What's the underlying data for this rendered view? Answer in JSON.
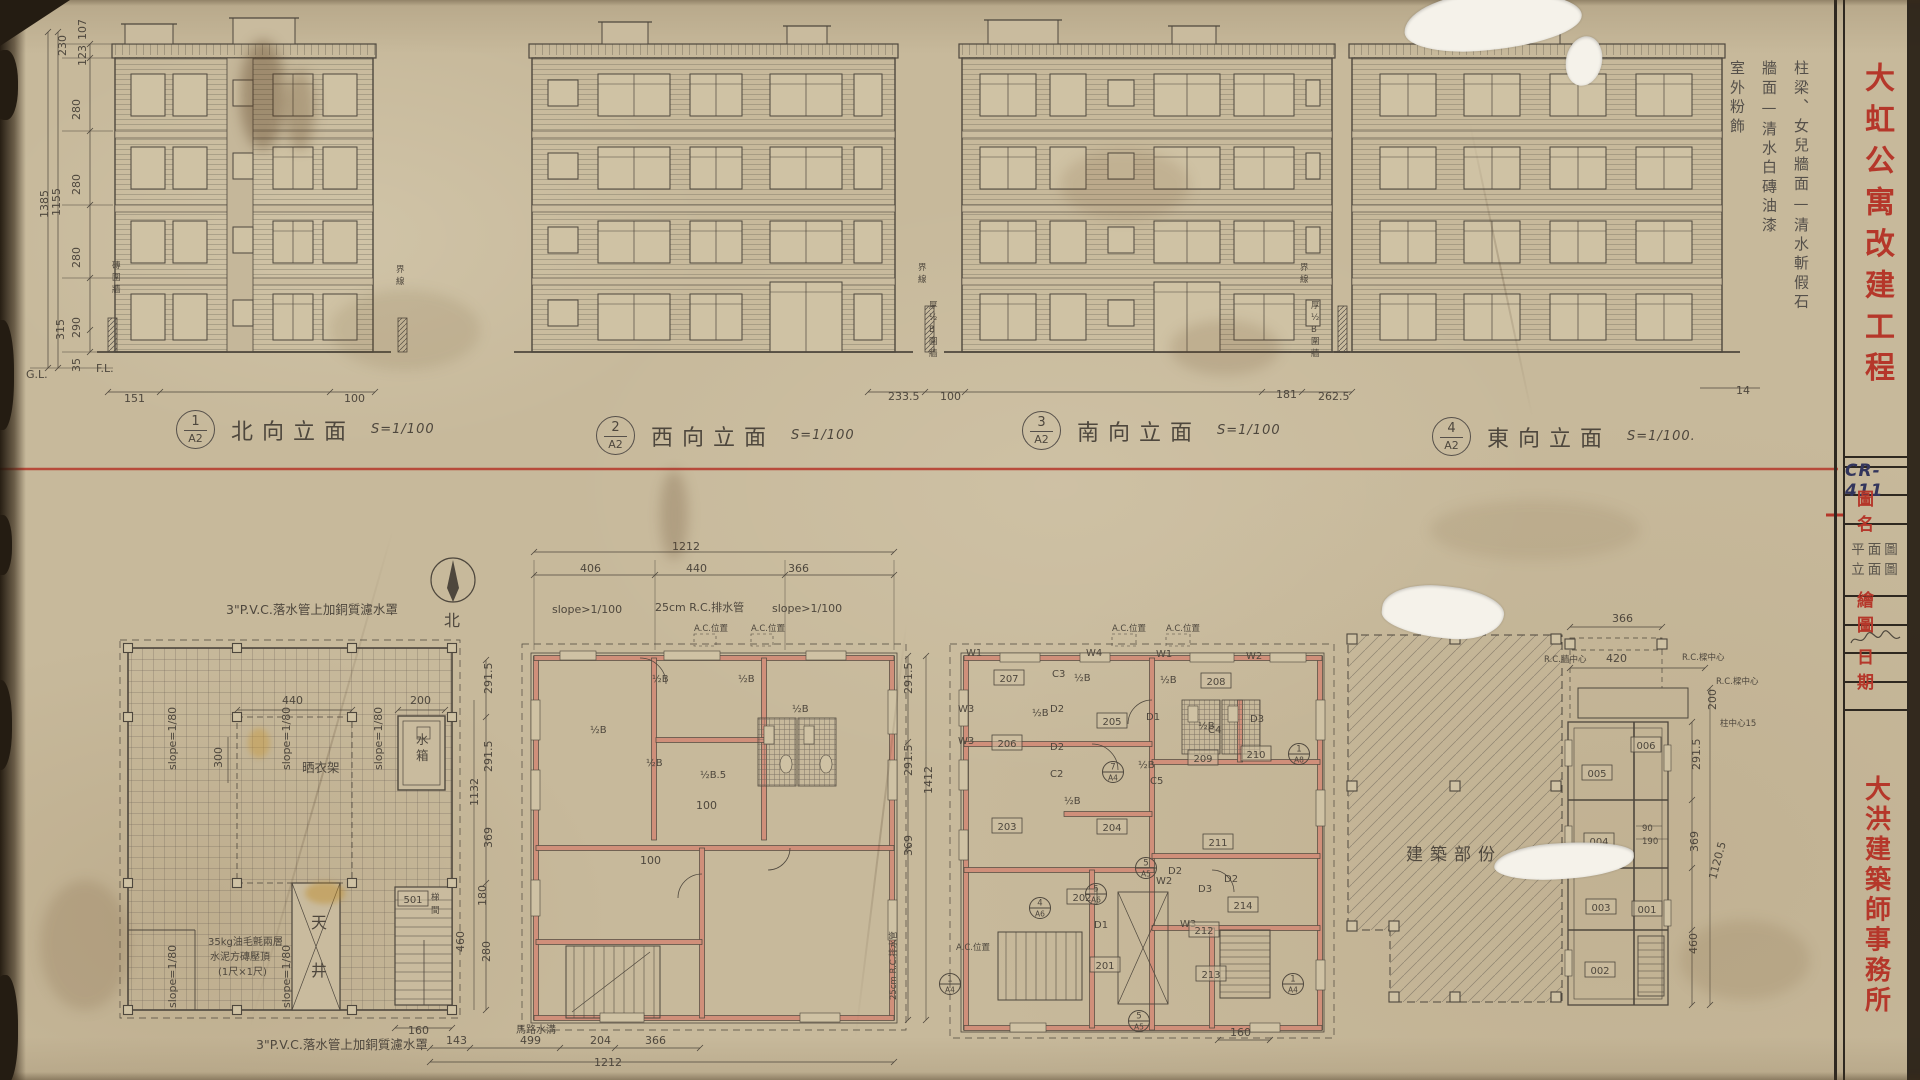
{
  "colors": {
    "paper": "#c7b99b",
    "pencil": "#4e473d",
    "red": "#b5372a",
    "wall_pink": "#d08f7a",
    "ink_blue": "#32355c"
  },
  "titleblock": {
    "code": "CR-411",
    "project": "大虹公寓改建工程",
    "name_label": "圖名",
    "drawing_names": [
      "平面圖",
      "立面圖"
    ],
    "drawn_label": "繪圖",
    "date_label": "日期",
    "office": "大洪建築師事務所"
  },
  "notes": {
    "finish": [
      "柱梁、女兒牆面—清水斬假石",
      "牆面—清水白磚油漆",
      "室外粉飾"
    ]
  },
  "elevations": [
    {
      "num": "1",
      "sheet": "A2",
      "title": "北向立面",
      "scale": "S=1/100"
    },
    {
      "num": "2",
      "sheet": "A2",
      "title": "西向立面",
      "scale": "S=1/100"
    },
    {
      "num": "3",
      "sheet": "A2",
      "title": "南向立面",
      "scale": "S=1/100"
    },
    {
      "num": "4",
      "sheet": "A2",
      "title": "東向立面",
      "scale": "S=1/100."
    }
  ],
  "compass": {
    "label": "北"
  },
  "labels": [
    {
      "t": "151",
      "x": 124,
      "y": 402,
      "cls": "dim"
    },
    {
      "t": "100",
      "x": 344,
      "y": 402,
      "cls": "dim"
    },
    {
      "t": "233.5",
      "x": 888,
      "y": 400,
      "cls": "dim"
    },
    {
      "t": "100",
      "x": 940,
      "y": 400,
      "cls": "dim"
    },
    {
      "t": "181",
      "x": 1276,
      "y": 398,
      "cls": "dim"
    },
    {
      "t": "262.5",
      "x": 1318,
      "y": 400,
      "cls": "dim"
    },
    {
      "t": "14",
      "x": 1736,
      "y": 394,
      "cls": "dim"
    },
    {
      "t": "230",
      "x": 66,
      "y": 56,
      "rot": -90,
      "cls": "dim"
    },
    {
      "t": "107",
      "x": 86,
      "y": 40,
      "rot": -90,
      "cls": "dim"
    },
    {
      "t": "123",
      "x": 86,
      "y": 66,
      "rot": -90,
      "cls": "dim"
    },
    {
      "t": "280",
      "x": 80,
      "y": 120,
      "rot": -90,
      "cls": "dim"
    },
    {
      "t": "280",
      "x": 80,
      "y": 195,
      "rot": -90,
      "cls": "dim"
    },
    {
      "t": "280",
      "x": 80,
      "y": 268,
      "rot": -90,
      "cls": "dim"
    },
    {
      "t": "315",
      "x": 64,
      "y": 340,
      "rot": -90,
      "cls": "dim"
    },
    {
      "t": "290",
      "x": 80,
      "y": 338,
      "rot": -90,
      "cls": "dim"
    },
    {
      "t": "35",
      "x": 80,
      "y": 372,
      "rot": -90,
      "cls": "dim"
    },
    {
      "t": "1385",
      "x": 48,
      "y": 218,
      "rot": -90,
      "cls": "dim"
    },
    {
      "t": "1155",
      "x": 60,
      "y": 216,
      "rot": -90,
      "cls": "dim"
    },
    {
      "t": "G.L.",
      "x": 26,
      "y": 378,
      "cls": "dim"
    },
    {
      "t": "F.L.",
      "x": 96,
      "y": 372,
      "cls": "dim"
    },
    {
      "t": "磚圍牆",
      "x": 112,
      "y": 268,
      "stack": true,
      "cls": "tiny"
    },
    {
      "t": "界線",
      "x": 918,
      "y": 270,
      "stack": true,
      "cls": "tiny"
    },
    {
      "t": "厚½B圍牆",
      "x": 929,
      "y": 308,
      "stack": true,
      "cls": "tiny"
    },
    {
      "t": "界線",
      "x": 1300,
      "y": 270,
      "stack": true,
      "cls": "tiny"
    },
    {
      "t": "厚½B圍牆",
      "x": 1311,
      "y": 308,
      "stack": true,
      "cls": "tiny"
    },
    {
      "t": "界線",
      "x": 396,
      "y": 272,
      "stack": true,
      "cls": "tiny"
    },
    {
      "t": "3\"P.V.C.落水管上加銅質濾水罩",
      "x": 226,
      "y": 614,
      "cls": "note"
    },
    {
      "t": "3\"P.V.C.落水管上加銅質濾水罩",
      "x": 256,
      "y": 1049,
      "cls": "note"
    },
    {
      "t": "35kg油毛氈兩層",
      "x": 208,
      "y": 945,
      "cls": "tag"
    },
    {
      "t": "水泥方磚壓頂",
      "x": 210,
      "y": 960,
      "cls": "tag"
    },
    {
      "t": "(1尺×1尺)",
      "x": 218,
      "y": 975,
      "cls": "tag"
    },
    {
      "t": "晒衣架",
      "x": 302,
      "y": 772,
      "cls": "note"
    },
    {
      "t": "水箱",
      "x": 416,
      "y": 744,
      "stack": true,
      "dy": 16,
      "cls": "note"
    },
    {
      "t": "天井",
      "x": 311,
      "y": 928,
      "stack": true,
      "dy": 48,
      "cls": "big"
    },
    {
      "t": "梯間",
      "x": 431,
      "y": 900,
      "stack": true,
      "dy": 13,
      "cls": "tiny"
    },
    {
      "t": "440",
      "x": 282,
      "y": 704,
      "cls": "dim"
    },
    {
      "t": "200",
      "x": 410,
      "y": 704,
      "cls": "dim"
    },
    {
      "t": "300",
      "x": 222,
      "y": 768,
      "rot": -90,
      "cls": "dim"
    },
    {
      "t": "160",
      "x": 408,
      "y": 1034,
      "cls": "dim"
    },
    {
      "t": "slope=1/80",
      "x": 176,
      "y": 770,
      "rot": -90,
      "cls": "dim"
    },
    {
      "t": "slope=1/80",
      "x": 290,
      "y": 770,
      "rot": -90,
      "cls": "dim"
    },
    {
      "t": "slope=1/80",
      "x": 382,
      "y": 770,
      "rot": -90,
      "cls": "dim"
    },
    {
      "t": "slope=1/80",
      "x": 176,
      "y": 1008,
      "rot": -90,
      "cls": "dim"
    },
    {
      "t": "slope=1/80",
      "x": 290,
      "y": 1008,
      "rot": -90,
      "cls": "dim"
    },
    {
      "t": "北",
      "x": 444,
      "y": 626,
      "cls": "big"
    },
    {
      "t": "291.5",
      "x": 492,
      "y": 694,
      "rot": -90,
      "cls": "dim"
    },
    {
      "t": "291.5",
      "x": 492,
      "y": 772,
      "rot": -90,
      "cls": "dim"
    },
    {
      "t": "1132",
      "x": 478,
      "y": 806,
      "rot": -90,
      "cls": "dim"
    },
    {
      "t": "369",
      "x": 492,
      "y": 848,
      "rot": -90,
      "cls": "dim"
    },
    {
      "t": "180",
      "x": 486,
      "y": 906,
      "rot": -90,
      "cls": "dim"
    },
    {
      "t": "280",
      "x": 490,
      "y": 962,
      "rot": -90,
      "cls": "dim"
    },
    {
      "t": "460",
      "x": 464,
      "y": 952,
      "rot": -90,
      "cls": "dim"
    },
    {
      "t": "1212",
      "x": 672,
      "y": 550,
      "cls": "dim"
    },
    {
      "t": "406",
      "x": 580,
      "y": 572,
      "cls": "dim"
    },
    {
      "t": "440",
      "x": 686,
      "y": 572,
      "cls": "dim"
    },
    {
      "t": "366",
      "x": 788,
      "y": 572,
      "cls": "dim"
    },
    {
      "t": "slope>1/100",
      "x": 552,
      "y": 613,
      "cls": "dim"
    },
    {
      "t": "25cm R.C.排水管",
      "x": 655,
      "y": 611,
      "cls": "dim"
    },
    {
      "t": "slope>1/100",
      "x": 772,
      "y": 612,
      "cls": "dim"
    },
    {
      "t": "A.C.位置",
      "x": 694,
      "y": 631,
      "cls": "tiny"
    },
    {
      "t": "A.C.位置",
      "x": 751,
      "y": 631,
      "cls": "tiny"
    },
    {
      "t": "½B",
      "x": 652,
      "y": 682,
      "cls": "tag"
    },
    {
      "t": "½B",
      "x": 738,
      "y": 682,
      "cls": "tag"
    },
    {
      "t": "½B",
      "x": 590,
      "y": 733,
      "cls": "tag"
    },
    {
      "t": "½B",
      "x": 646,
      "y": 766,
      "cls": "tag"
    },
    {
      "t": "½B",
      "x": 792,
      "y": 712,
      "cls": "tag"
    },
    {
      "t": "½B.5",
      "x": 700,
      "y": 778,
      "cls": "tag"
    },
    {
      "t": "100",
      "x": 696,
      "y": 809,
      "cls": "dim"
    },
    {
      "t": "100",
      "x": 640,
      "y": 864,
      "cls": "dim"
    },
    {
      "t": "291.5",
      "x": 912,
      "y": 694,
      "rot": -90,
      "cls": "dim"
    },
    {
      "t": "291.5",
      "x": 912,
      "y": 776,
      "rot": -90,
      "cls": "dim"
    },
    {
      "t": "369",
      "x": 912,
      "y": 856,
      "rot": -90,
      "cls": "dim"
    },
    {
      "t": "1412",
      "x": 932,
      "y": 794,
      "rot": -90,
      "cls": "dim"
    },
    {
      "t": "25cm R.C.排水管",
      "x": 896,
      "y": 1000,
      "rot": -90,
      "cls": "tiny"
    },
    {
      "t": "143",
      "x": 446,
      "y": 1044,
      "cls": "dim"
    },
    {
      "t": "499",
      "x": 520,
      "y": 1044,
      "cls": "dim"
    },
    {
      "t": "204",
      "x": 590,
      "y": 1044,
      "cls": "dim"
    },
    {
      "t": "366",
      "x": 645,
      "y": 1044,
      "cls": "dim"
    },
    {
      "t": "1212",
      "x": 594,
      "y": 1066,
      "cls": "dim"
    },
    {
      "t": "馬路水溝",
      "x": 516,
      "y": 1033,
      "cls": "tag"
    },
    {
      "t": "A.C.位置",
      "x": 1112,
      "y": 631,
      "cls": "tiny"
    },
    {
      "t": "A.C.位置",
      "x": 1166,
      "y": 631,
      "cls": "tiny"
    },
    {
      "t": "W1",
      "x": 966,
      "y": 656,
      "cls": "tag"
    },
    {
      "t": "W4",
      "x": 1086,
      "y": 656,
      "cls": "tag"
    },
    {
      "t": "W1",
      "x": 1156,
      "y": 657,
      "cls": "tag"
    },
    {
      "t": "W2",
      "x": 1246,
      "y": 659,
      "cls": "tag"
    },
    {
      "t": "W3",
      "x": 958,
      "y": 712,
      "cls": "tag"
    },
    {
      "t": "W3",
      "x": 958,
      "y": 744,
      "cls": "tag"
    },
    {
      "t": "W2",
      "x": 1156,
      "y": 884,
      "cls": "tag"
    },
    {
      "t": "W3",
      "x": 1180,
      "y": 927,
      "cls": "tag"
    },
    {
      "t": "D2",
      "x": 1050,
      "y": 712,
      "cls": "tag"
    },
    {
      "t": "D2",
      "x": 1050,
      "y": 750,
      "cls": "tag"
    },
    {
      "t": "D1",
      "x": 1146,
      "y": 720,
      "cls": "tag"
    },
    {
      "t": "D3",
      "x": 1250,
      "y": 722,
      "cls": "tag"
    },
    {
      "t": "D1",
      "x": 1094,
      "y": 928,
      "cls": "tag"
    },
    {
      "t": "D2",
      "x": 1168,
      "y": 874,
      "cls": "tag"
    },
    {
      "t": "D3",
      "x": 1198,
      "y": 892,
      "cls": "tag"
    },
    {
      "t": "D2",
      "x": 1224,
      "y": 882,
      "cls": "tag"
    },
    {
      "t": "C3",
      "x": 1052,
      "y": 677,
      "cls": "tag"
    },
    {
      "t": "C2",
      "x": 1050,
      "y": 777,
      "cls": "tag"
    },
    {
      "t": "C4",
      "x": 1208,
      "y": 733,
      "cls": "tag"
    },
    {
      "t": "C5",
      "x": 1150,
      "y": 784,
      "cls": "tag"
    },
    {
      "t": "½B",
      "x": 1074,
      "y": 681,
      "cls": "tag"
    },
    {
      "t": "½B",
      "x": 1160,
      "y": 683,
      "cls": "tag"
    },
    {
      "t": "½B",
      "x": 1032,
      "y": 716,
      "cls": "tag"
    },
    {
      "t": "½B",
      "x": 1198,
      "y": 729,
      "cls": "tag"
    },
    {
      "t": "½B",
      "x": 1138,
      "y": 768,
      "cls": "tag"
    },
    {
      "t": "½B",
      "x": 1064,
      "y": 804,
      "cls": "tag"
    },
    {
      "t": "160",
      "x": 1230,
      "y": 1036,
      "cls": "dim"
    },
    {
      "t": "A.C.位置",
      "x": 956,
      "y": 950,
      "cls": "tiny"
    },
    {
      "t": "建築部份",
      "x": 1406,
      "y": 860,
      "cls": "huge"
    },
    {
      "t": "366",
      "x": 1612,
      "y": 622,
      "cls": "dim"
    },
    {
      "t": "420",
      "x": 1606,
      "y": 662,
      "cls": "dim"
    },
    {
      "t": "R.C.牆中心",
      "x": 1544,
      "y": 662,
      "cls": "tiny"
    },
    {
      "t": "R.C.樑中心",
      "x": 1682,
      "y": 660,
      "cls": "tiny"
    },
    {
      "t": "R.C.樑中心",
      "x": 1716,
      "y": 684,
      "cls": "tiny"
    },
    {
      "t": "柱中心15",
      "x": 1720,
      "y": 726,
      "cls": "tiny"
    },
    {
      "t": "200",
      "x": 1716,
      "y": 710,
      "rot": -90,
      "cls": "dim"
    },
    {
      "t": "291.5",
      "x": 1700,
      "y": 770,
      "rot": -90,
      "cls": "dim"
    },
    {
      "t": "90",
      "x": 1642,
      "y": 831,
      "cls": "tiny"
    },
    {
      "t": "190",
      "x": 1642,
      "y": 844,
      "cls": "tiny"
    },
    {
      "t": "369",
      "x": 1698,
      "y": 852,
      "rot": -90,
      "cls": "dim"
    },
    {
      "t": "1120.5",
      "x": 1716,
      "y": 880,
      "rot": -75,
      "cls": "dim"
    },
    {
      "t": "460",
      "x": 1697,
      "y": 954,
      "rot": -90,
      "cls": "dim"
    }
  ],
  "room_tags": [
    {
      "t": "501",
      "x": 413,
      "y": 902
    },
    {
      "t": "207",
      "x": 1009,
      "y": 681
    },
    {
      "t": "208",
      "x": 1216,
      "y": 684
    },
    {
      "t": "205",
      "x": 1112,
      "y": 724
    },
    {
      "t": "206",
      "x": 1007,
      "y": 746
    },
    {
      "t": "203",
      "x": 1007,
      "y": 829
    },
    {
      "t": "204",
      "x": 1112,
      "y": 830
    },
    {
      "t": "209",
      "x": 1203,
      "y": 761
    },
    {
      "t": "210",
      "x": 1256,
      "y": 757
    },
    {
      "t": "202",
      "x": 1082,
      "y": 900
    },
    {
      "t": "201",
      "x": 1105,
      "y": 968
    },
    {
      "t": "211",
      "x": 1218,
      "y": 845
    },
    {
      "t": "212",
      "x": 1204,
      "y": 933
    },
    {
      "t": "213",
      "x": 1211,
      "y": 977
    },
    {
      "t": "214",
      "x": 1243,
      "y": 908
    },
    {
      "t": "006",
      "x": 1646,
      "y": 748
    },
    {
      "t": "005",
      "x": 1597,
      "y": 776
    },
    {
      "t": "004",
      "x": 1599,
      "y": 844
    },
    {
      "t": "003",
      "x": 1601,
      "y": 910
    },
    {
      "t": "001",
      "x": 1647,
      "y": 912
    },
    {
      "t": "002",
      "x": 1600,
      "y": 973
    }
  ],
  "section_markers": [
    {
      "num": "1",
      "sheet": "A4",
      "x": 950,
      "y": 984
    },
    {
      "num": "1",
      "sheet": "A4",
      "x": 1293,
      "y": 984
    },
    {
      "num": "1",
      "sheet": "A8",
      "x": 1299,
      "y": 754
    },
    {
      "num": "4",
      "sheet": "A6",
      "x": 1040,
      "y": 908
    },
    {
      "num": "5",
      "sheet": "A6",
      "x": 1096,
      "y": 894
    },
    {
      "num": "7",
      "sheet": "A4",
      "x": 1113,
      "y": 772
    },
    {
      "num": "5",
      "sheet": "A5",
      "x": 1146,
      "y": 868
    },
    {
      "num": "5",
      "sheet": "A5",
      "x": 1139,
      "y": 1021
    }
  ]
}
